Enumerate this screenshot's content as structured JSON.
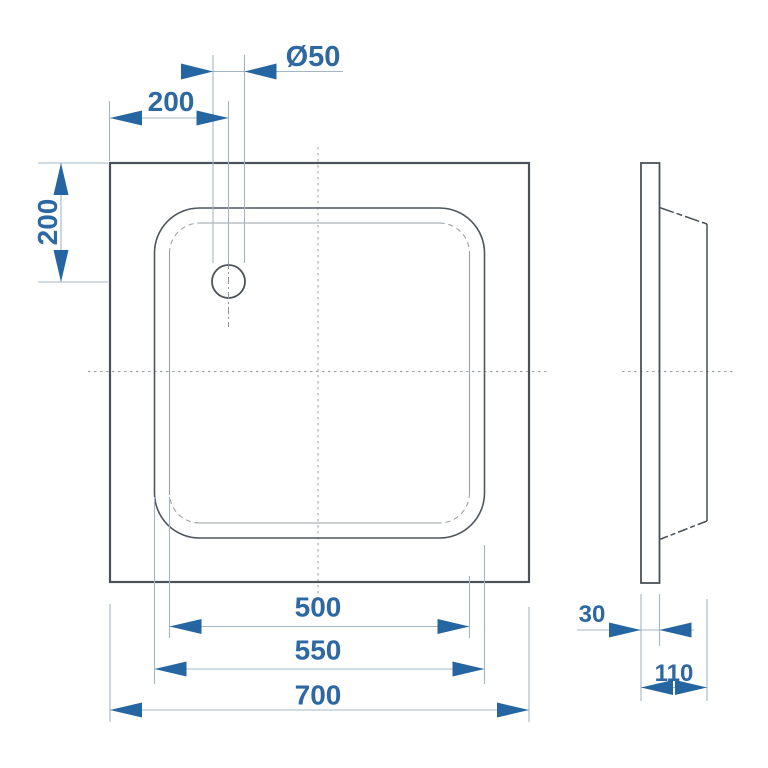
{
  "drawing": {
    "subject": "square shower tray technical drawing, plan view and side profile view",
    "colors": {
      "accent_blue_text": "#2e68a2",
      "accent_blue_arrow": "#2565a2",
      "dimension_line": "#a4b6c6",
      "outline_dark": "#4a5158",
      "thin_gray": "#9ba1a7",
      "centerline_gray": "#9aa0a6",
      "background": "#ffffff"
    },
    "plan_view": {
      "dimensions": {
        "drain_diameter": "Ø50",
        "drain_offset_x": "200",
        "drain_offset_y": "200",
        "floor_width": "500",
        "rim_width": "550",
        "overall_width": "700"
      }
    },
    "side_view": {
      "dimensions": {
        "flange_thickness": "30",
        "overall_depth": "110"
      }
    }
  }
}
